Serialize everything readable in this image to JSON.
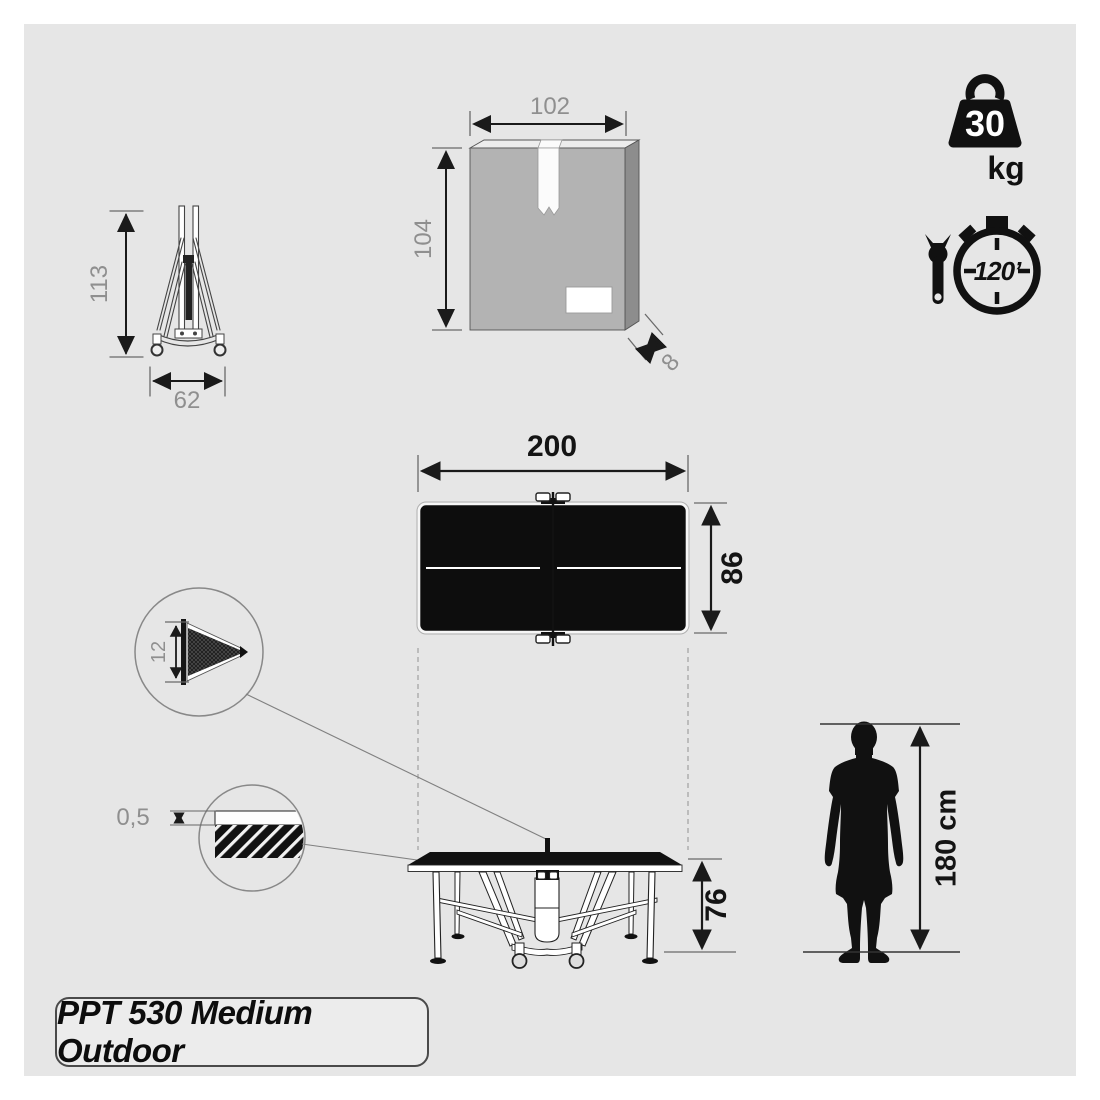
{
  "product": {
    "name": "PPT 530 Medium Outdoor"
  },
  "icons": {
    "weight": {
      "name": "weight-icon",
      "value": "30",
      "unit": "kg"
    },
    "assembly_time": {
      "name": "stopwatch-wrench-icon",
      "value": "120’"
    }
  },
  "dimensions": {
    "folded_height": "113",
    "folded_width": "62",
    "box_width": "102",
    "box_height": "104",
    "box_depth": "8",
    "table_length": "200",
    "table_width": "86",
    "net_height": "12",
    "top_thickness": "0,5",
    "table_height": "76",
    "person_height": "180 cm"
  },
  "colors": {
    "background": "#e6e6e6",
    "ink": "#141414",
    "dim_gray_text": "#8f8f8f",
    "box_front": "#b3b3b3",
    "box_side": "#8d8d8d"
  }
}
